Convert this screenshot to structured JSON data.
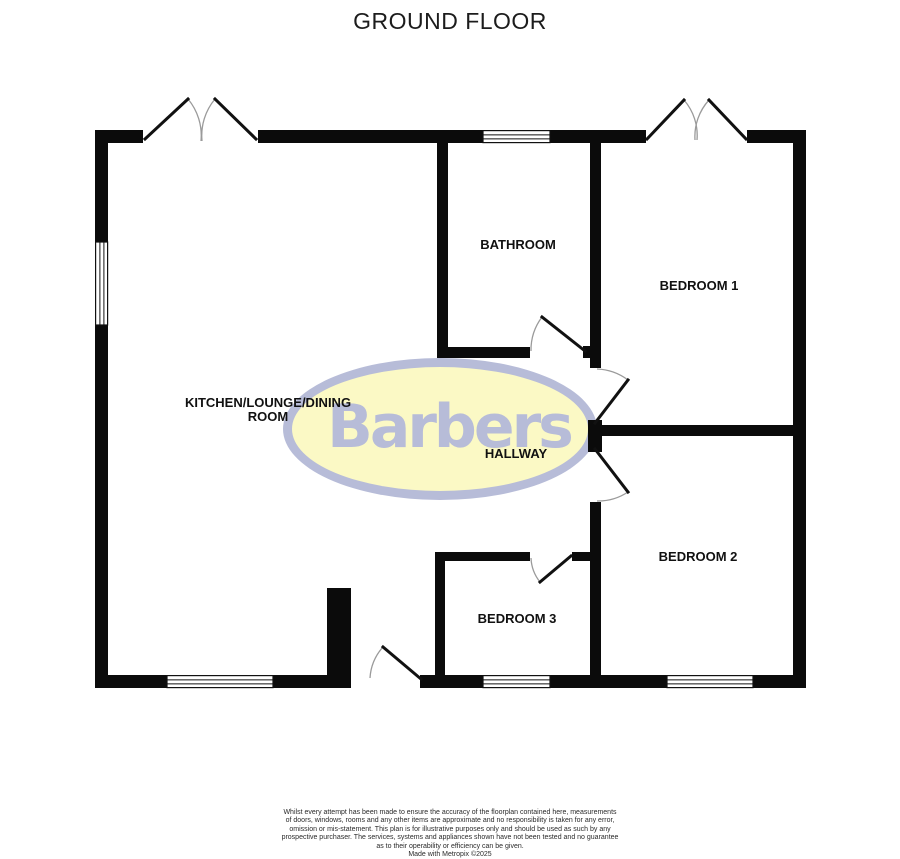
{
  "title": "GROUND FLOOR",
  "logo": {
    "text": "Barbers",
    "accent_color": "#b7bcd8",
    "ellipse_fill": "#fbf9c5"
  },
  "rooms": {
    "kitchen": {
      "label_line1": "KITCHEN/LOUNGE/DINING",
      "label_line2": "ROOM"
    },
    "bathroom": {
      "label": "BATHROOM"
    },
    "bedroom1": {
      "label": "BEDROOM 1"
    },
    "hallway": {
      "label": "HALLWAY"
    },
    "bedroom2": {
      "label": "BEDROOM 2"
    },
    "bedroom3": {
      "label": "BEDROOM 3"
    }
  },
  "footer": {
    "disclaimer_lines": [
      "Whilst every attempt has been made to ensure the accuracy of the floorplan contained here, measurements",
      "of doors, windows, rooms and any other items are approximate and no responsibility is taken for any error,",
      "omission or mis-statement. This plan is for illustrative purposes only and should be used as such by any",
      "prospective purchaser. The services, systems and appliances shown have not been tested and no guarantee",
      "as to their operability or efficiency can be given."
    ],
    "credit": "Made with Metropix ©2025"
  }
}
